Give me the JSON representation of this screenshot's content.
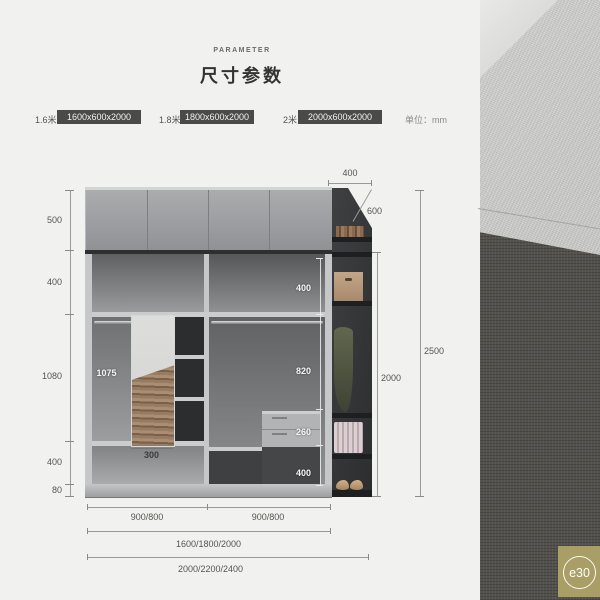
{
  "header": {
    "eyebrow": "PARAMETER",
    "title": "尺寸参数"
  },
  "size_bar": {
    "options": [
      {
        "label": "1.6米",
        "value": "1600x600x2000"
      },
      {
        "label": "1.8米",
        "value": "1800x600x2000"
      },
      {
        "label": "2米",
        "value": "2000x600x2000"
      }
    ],
    "unit_note": "单位：mm"
  },
  "diagram": {
    "left_heights": [
      "500",
      "400",
      "1080",
      "400",
      "80"
    ],
    "top_depth": "400",
    "slant_depth": "600",
    "inner_height": "2000",
    "total_height": "2500",
    "hanging_height": "1075",
    "mirror_width": "300",
    "right_column_heights": [
      "400",
      "820",
      "260",
      "400"
    ],
    "bottom_row1": [
      "900/800",
      "900/800"
    ],
    "bottom_row2": "1600/1800/2000",
    "bottom_row3": "2000/2200/2400"
  },
  "watermark": {
    "text": "e30"
  },
  "colors": {
    "page_bg": "#f1f1ef",
    "badge_bg": "#4a4a48",
    "watermark_bg": "#a89e66"
  }
}
